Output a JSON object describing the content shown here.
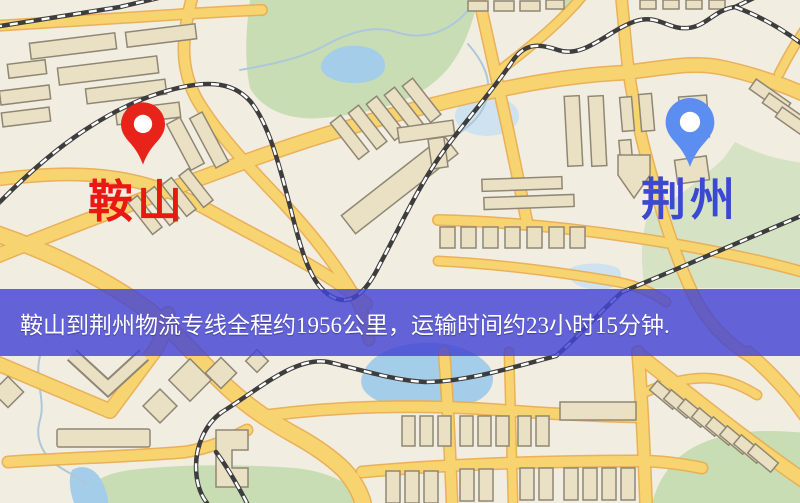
{
  "route_info_banner": {
    "text": "鞍山到荆州物流专线全程约1956公里，运输时间约23小时15分钟.",
    "background_color": "#4343d4",
    "text_color": "#ffffff"
  },
  "markers": {
    "origin": {
      "label": "鞍山",
      "label_color": "#e81812",
      "pin_color": "#e8231a"
    },
    "destination": {
      "label": "荆州",
      "label_color": "#3b49d2",
      "pin_color": "#5c8df0"
    }
  },
  "map_palette": {
    "background": "#f2ede1",
    "road": "#f7d470",
    "road_casing": "#e9ad52",
    "railway": "#3d3d3d",
    "railway_dash": "#ffffff",
    "water": "#a3cde9",
    "park": "#c9ddb5",
    "building_fill": "#eae1c5",
    "building_stroke": "#8f8774"
  }
}
